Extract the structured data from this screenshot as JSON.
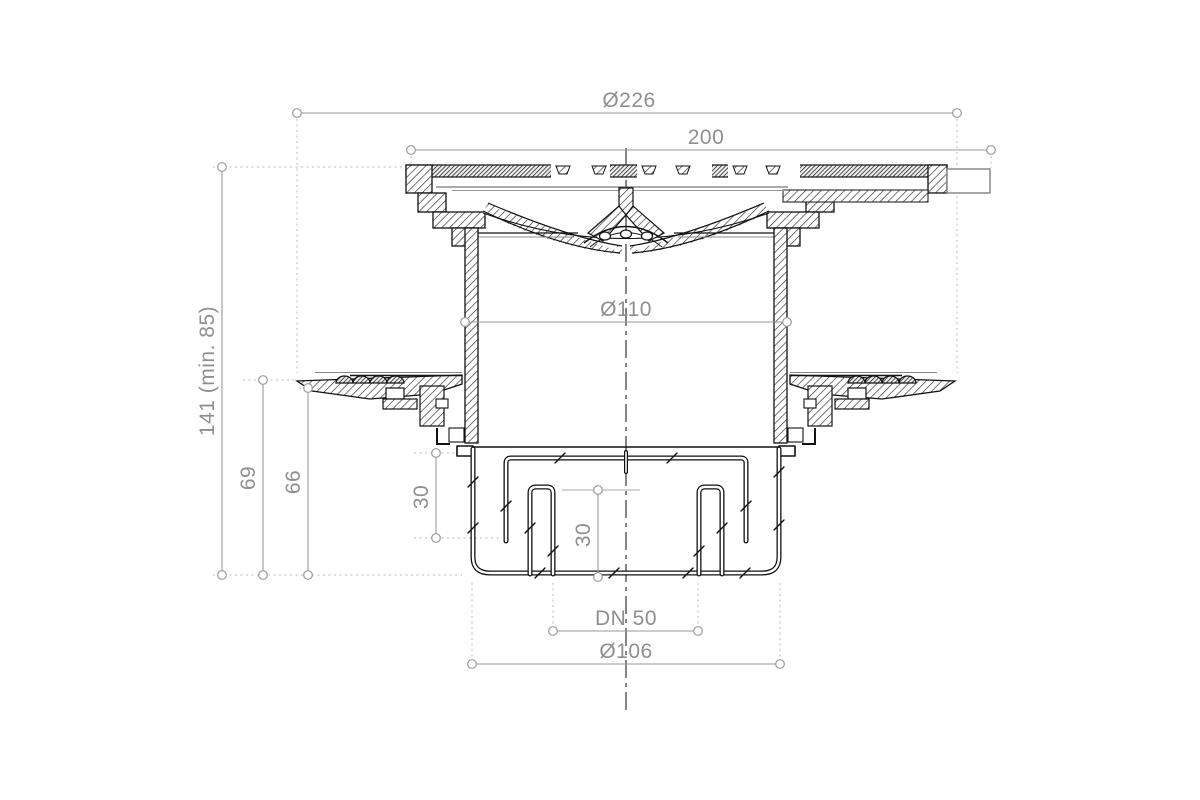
{
  "drawing": {
    "type": "technical-cross-section",
    "subject": "floor drain with vertical outlet, clamping flange and grate",
    "labels": {
      "flange_diameter": "Ø226",
      "frame_width": "200",
      "body_diameter": "Ø110",
      "installation_height": "141 (min. 85)",
      "height_to_flange_top": "69",
      "height_to_flange_seal": "66",
      "trap_depth_outer": "30",
      "water_seal_depth": "30",
      "outlet_size": "DN 50",
      "base_diameter": "Ø106"
    },
    "colors": {
      "background": "#ffffff",
      "part_line": "#111111",
      "dimension_line": "#9a9a9a",
      "dimension_text": "#8f8f8f",
      "extension_line": "#b8b8b8"
    }
  }
}
